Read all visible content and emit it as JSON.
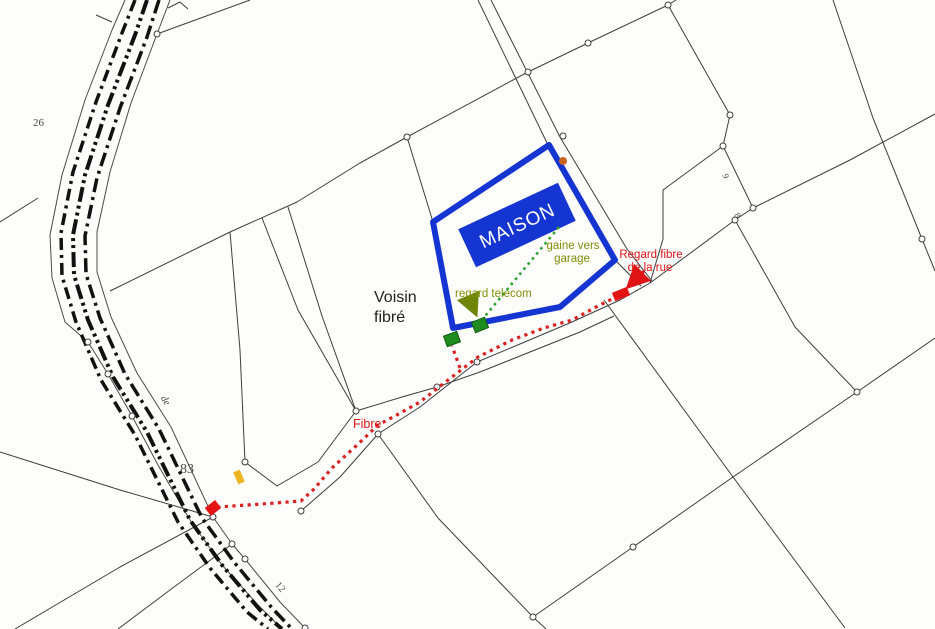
{
  "map": {
    "type": "cadastral-plan-with-fiber-annotations",
    "labels": {
      "maison": "MAISON",
      "voisin_line1": "Voisin",
      "voisin_line2": "fibré",
      "gaine_line1": "gaine vers",
      "gaine_line2": "garage",
      "regard_telecom": "regard telecom",
      "regard_fibre_line1": "Regard fibre",
      "regard_fibre_line2": "de la rue",
      "fibre": "Fibre"
    },
    "parcel_numbers": {
      "n26": "26",
      "n83": "83",
      "n12": "12",
      "n9": "9",
      "n8": "8",
      "road_text": "de"
    },
    "colors": {
      "property_blue": "#1535d2",
      "fiber_red": "#d92121",
      "annotation_red": "#e01414",
      "manhole_green": "#1e8c1e",
      "conduit_green": "#2fa32f",
      "olive_text": "#7d8f04",
      "marker_yellow": "#edb41f",
      "parcel_line_gray": "#3d3d3d"
    }
  }
}
